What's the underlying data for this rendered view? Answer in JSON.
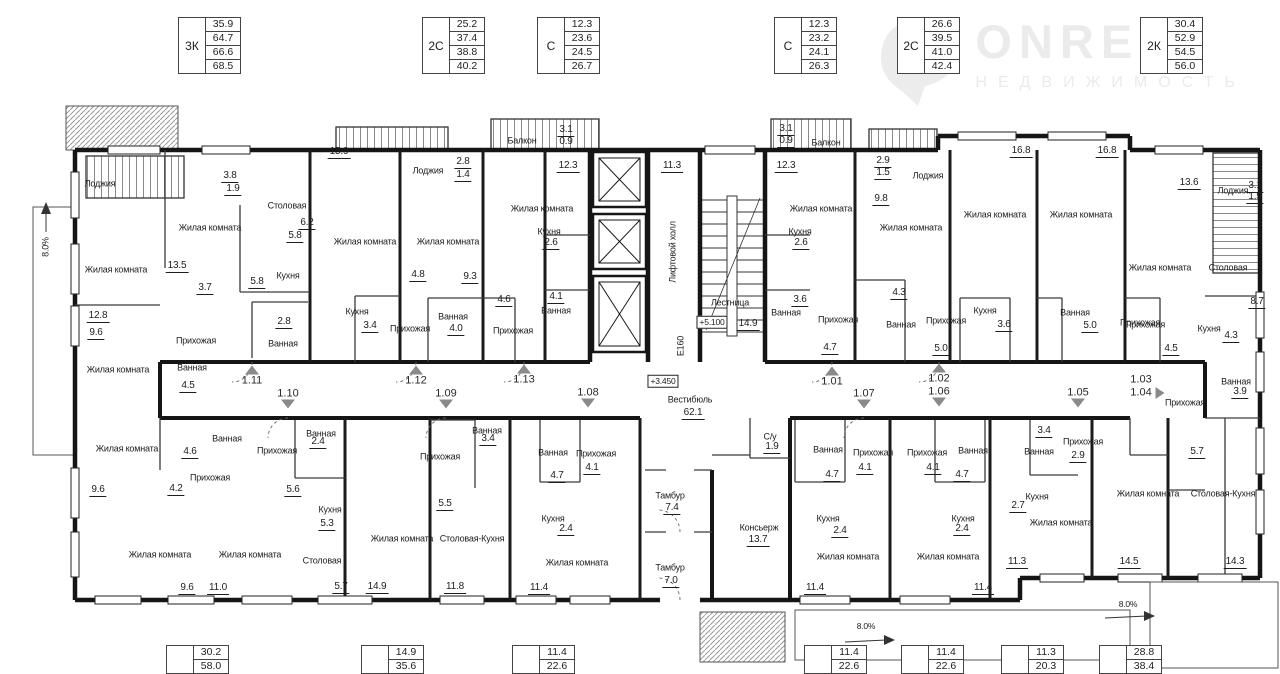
{
  "logo": {
    "name": "ONRELT",
    "subtitle": "НЕДВИЖИМОСТЬ"
  },
  "unit_tables_top": [
    {
      "type": "3К",
      "values": [
        "35.9",
        "64.7",
        "66.6",
        "68.5"
      ],
      "x": 178,
      "y": 17
    },
    {
      "type": "2С",
      "values": [
        "25.2",
        "37.4",
        "38.8",
        "40.2"
      ],
      "x": 422,
      "y": 17
    },
    {
      "type": "С",
      "values": [
        "12.3",
        "23.6",
        "24.5",
        "26.7"
      ],
      "x": 537,
      "y": 17
    },
    {
      "type": "С",
      "values": [
        "12.3",
        "23.2",
        "24.1",
        "26.3"
      ],
      "x": 774,
      "y": 17
    },
    {
      "type": "2С",
      "values": [
        "26.6",
        "39.5",
        "41.0",
        "42.4"
      ],
      "x": 897,
      "y": 17
    },
    {
      "type": "2К",
      "values": [
        "30.4",
        "52.9",
        "54.5",
        "56.0"
      ],
      "x": 1140,
      "y": 17
    }
  ],
  "unit_tables_bottom": [
    {
      "type": "",
      "values": [
        "30.2",
        "58.0"
      ],
      "x": 166,
      "y": 645
    },
    {
      "type": "",
      "values": [
        "14.9",
        "35.6"
      ],
      "x": 361,
      "y": 645
    },
    {
      "type": "",
      "values": [
        "11.4",
        "22.6"
      ],
      "x": 512,
      "y": 645
    },
    {
      "type": "",
      "values": [
        "11.4",
        "22.6"
      ],
      "x": 804,
      "y": 645
    },
    {
      "type": "",
      "values": [
        "11.4",
        "22.6"
      ],
      "x": 901,
      "y": 645
    },
    {
      "type": "",
      "values": [
        "11.3",
        "20.3"
      ],
      "x": 1001,
      "y": 645
    },
    {
      "type": "",
      "values": [
        "28.8",
        "38.4"
      ],
      "x": 1099,
      "y": 645
    }
  ],
  "plan": {
    "rooms": [
      {
        "t": "Лоджия",
        "x": 100,
        "y": 184
      },
      {
        "t": "Жилая комната",
        "x": 210,
        "y": 228
      },
      {
        "t": "Столовая",
        "x": 287,
        "y": 206
      },
      {
        "t": "Жилая комната",
        "x": 116,
        "y": 270
      },
      {
        "t": "Кухня",
        "x": 288,
        "y": 276
      },
      {
        "t": "Прихожая",
        "x": 196,
        "y": 341
      },
      {
        "t": "Ванная",
        "x": 283,
        "y": 344
      },
      {
        "t": "Ванная",
        "x": 192,
        "y": 368
      },
      {
        "t": "Жилая комната",
        "x": 118,
        "y": 370
      },
      {
        "t": "Лоджия",
        "x": 428,
        "y": 171
      },
      {
        "t": "Жилая комната",
        "x": 365,
        "y": 242
      },
      {
        "t": "Жилая комната",
        "x": 448,
        "y": 242
      },
      {
        "t": "Кухня",
        "x": 357,
        "y": 312
      },
      {
        "t": "Прихожая",
        "x": 410,
        "y": 329
      },
      {
        "t": "Ванная",
        "x": 453,
        "y": 317
      },
      {
        "t": "Прихожая",
        "x": 513,
        "y": 331
      },
      {
        "t": "Балкон",
        "x": 522,
        "y": 141
      },
      {
        "t": "Жилая комната",
        "x": 542,
        "y": 209
      },
      {
        "t": "Кухня",
        "x": 549,
        "y": 232
      },
      {
        "t": "Ванная",
        "x": 556,
        "y": 311
      },
      {
        "t": "Балкон",
        "x": 826,
        "y": 143
      },
      {
        "t": "Жилая комната",
        "x": 821,
        "y": 209
      },
      {
        "t": "Кухня",
        "x": 800,
        "y": 232
      },
      {
        "t": "Ванная",
        "x": 786,
        "y": 313
      },
      {
        "t": "Прихожая",
        "x": 838,
        "y": 320
      },
      {
        "t": "Лоджия",
        "x": 928,
        "y": 176
      },
      {
        "t": "Жилая комната",
        "x": 911,
        "y": 228
      },
      {
        "t": "Жилая комната",
        "x": 995,
        "y": 215
      },
      {
        "t": "Жилая комната",
        "x": 1081,
        "y": 215
      },
      {
        "t": "Ванная",
        "x": 901,
        "y": 325
      },
      {
        "t": "Прихожая",
        "x": 946,
        "y": 321
      },
      {
        "t": "Кухня",
        "x": 985,
        "y": 311
      },
      {
        "t": "Ванная",
        "x": 1075,
        "y": 313
      },
      {
        "t": "Прихожая",
        "x": 1140,
        "y": 323
      },
      {
        "t": "Лоджия",
        "x": 1233,
        "y": 191
      },
      {
        "t": "Жилая комната",
        "x": 1160,
        "y": 268
      },
      {
        "t": "Столовая",
        "x": 1228,
        "y": 268
      },
      {
        "t": "Прихожая",
        "x": 1145,
        "y": 325
      },
      {
        "t": "Кухня",
        "x": 1209,
        "y": 329
      },
      {
        "t": "Ванная",
        "x": 1236,
        "y": 382
      },
      {
        "t": "Лестница",
        "x": 730,
        "y": 303
      },
      {
        "t": "Вестибюль",
        "x": 690,
        "y": 400
      },
      {
        "t": "Тамбур",
        "x": 670,
        "y": 496
      },
      {
        "t": "Тамбур",
        "x": 670,
        "y": 568
      },
      {
        "t": "Консьерж",
        "x": 759,
        "y": 528
      },
      {
        "t": "С/у",
        "x": 770,
        "y": 437
      },
      {
        "t": "Ванная",
        "x": 227,
        "y": 439
      },
      {
        "t": "Жилая комната",
        "x": 127,
        "y": 449
      },
      {
        "t": "Прихожая",
        "x": 277,
        "y": 451
      },
      {
        "t": "Прихожая",
        "x": 210,
        "y": 478
      },
      {
        "t": "Ванная",
        "x": 321,
        "y": 434
      },
      {
        "t": "Кухня",
        "x": 330,
        "y": 510
      },
      {
        "t": "Жилая комната",
        "x": 160,
        "y": 555
      },
      {
        "t": "Жилая комната",
        "x": 250,
        "y": 555
      },
      {
        "t": "Столовая",
        "x": 322,
        "y": 561
      },
      {
        "t": "Жилая комната",
        "x": 402,
        "y": 539
      },
      {
        "t": "Столовая-Кухня",
        "x": 472,
        "y": 539
      },
      {
        "t": "Прихожая",
        "x": 440,
        "y": 457
      },
      {
        "t": "Ванная",
        "x": 487,
        "y": 431
      },
      {
        "t": "Ванная",
        "x": 553,
        "y": 453
      },
      {
        "t": "Прихожая",
        "x": 596,
        "y": 454
      },
      {
        "t": "Кухня",
        "x": 553,
        "y": 519
      },
      {
        "t": "Жилая комната",
        "x": 577,
        "y": 563
      },
      {
        "t": "Ванная",
        "x": 828,
        "y": 450
      },
      {
        "t": "Прихожая",
        "x": 873,
        "y": 453
      },
      {
        "t": "Кухня",
        "x": 828,
        "y": 519
      },
      {
        "t": "Жилая комната",
        "x": 848,
        "y": 557
      },
      {
        "t": "Прихожая",
        "x": 927,
        "y": 453
      },
      {
        "t": "Ванная",
        "x": 973,
        "y": 451
      },
      {
        "t": "Кухня",
        "x": 963,
        "y": 519
      },
      {
        "t": "Жилая комната",
        "x": 948,
        "y": 557
      },
      {
        "t": "Ванная",
        "x": 1039,
        "y": 452
      },
      {
        "t": "Прихожая",
        "x": 1083,
        "y": 442
      },
      {
        "t": "Кухня",
        "x": 1037,
        "y": 497
      },
      {
        "t": "Жилая комната",
        "x": 1061,
        "y": 523
      },
      {
        "t": "Прихожая",
        "x": 1185,
        "y": 403
      },
      {
        "t": "Жилая комната",
        "x": 1148,
        "y": 494
      },
      {
        "t": "Столовая-Кухня",
        "x": 1223,
        "y": 494
      }
    ],
    "areas": [
      {
        "t": "3.8",
        "x": 230,
        "y": 177
      },
      {
        "t": "1.9",
        "x": 233,
        "y": 190
      },
      {
        "t": "13.5",
        "x": 177,
        "y": 267
      },
      {
        "t": "6.2",
        "x": 307,
        "y": 224
      },
      {
        "t": "5.8",
        "x": 295,
        "y": 237
      },
      {
        "t": "5.8",
        "x": 257,
        "y": 283
      },
      {
        "t": "3.7",
        "x": 205,
        "y": 289
      },
      {
        "t": "12.8",
        "x": 98,
        "y": 317
      },
      {
        "t": "9.6",
        "x": 96,
        "y": 334
      },
      {
        "t": "2.8",
        "x": 284,
        "y": 323
      },
      {
        "t": "4.5",
        "x": 188,
        "y": 387
      },
      {
        "t": "15.9",
        "x": 339,
        "y": 153
      },
      {
        "t": "2.8",
        "x": 463,
        "y": 163
      },
      {
        "t": "1.4",
        "x": 463,
        "y": 176
      },
      {
        "t": "4.8",
        "x": 418,
        "y": 276
      },
      {
        "t": "9.3",
        "x": 470,
        "y": 278
      },
      {
        "t": "3.4",
        "x": 370,
        "y": 327
      },
      {
        "t": "4.0",
        "x": 456,
        "y": 330
      },
      {
        "t": "4.6",
        "x": 504,
        "y": 301
      },
      {
        "t": "3.1",
        "x": 566,
        "y": 131
      },
      {
        "t": "0.9",
        "x": 566,
        "y": 143
      },
      {
        "t": "12.3",
        "x": 568,
        "y": 167
      },
      {
        "t": "2.6",
        "x": 551,
        "y": 244
      },
      {
        "t": "4.1",
        "x": 556,
        "y": 298
      },
      {
        "t": "11.3",
        "x": 672,
        "y": 167
      },
      {
        "t": "14.9",
        "x": 748,
        "y": 325
      },
      {
        "t": "3.1",
        "x": 786,
        "y": 130
      },
      {
        "t": "0.9",
        "x": 786,
        "y": 142
      },
      {
        "t": "12.3",
        "x": 786,
        "y": 167
      },
      {
        "t": "2.6",
        "x": 801,
        "y": 244
      },
      {
        "t": "3.6",
        "x": 800,
        "y": 301
      },
      {
        "t": "4.7",
        "x": 830,
        "y": 349
      },
      {
        "t": "2.9",
        "x": 883,
        "y": 162
      },
      {
        "t": "1.5",
        "x": 883,
        "y": 174
      },
      {
        "t": "9.8",
        "x": 881,
        "y": 200
      },
      {
        "t": "16.8",
        "x": 1021,
        "y": 152
      },
      {
        "t": "16.8",
        "x": 1107,
        "y": 152
      },
      {
        "t": "4.3",
        "x": 899,
        "y": 294
      },
      {
        "t": "5.0",
        "x": 941,
        "y": 350
      },
      {
        "t": "3.6",
        "x": 1004,
        "y": 326
      },
      {
        "t": "5.0",
        "x": 1090,
        "y": 327
      },
      {
        "t": "13.6",
        "x": 1189,
        "y": 184
      },
      {
        "t": "3.1",
        "x": 1255,
        "y": 187
      },
      {
        "t": "1.5",
        "x": 1255,
        "y": 198
      },
      {
        "t": "8.7",
        "x": 1257,
        "y": 303
      },
      {
        "t": "4.3",
        "x": 1231,
        "y": 337
      },
      {
        "t": "4.5",
        "x": 1171,
        "y": 350
      },
      {
        "t": "3.9",
        "x": 1240,
        "y": 393
      },
      {
        "t": "62.1",
        "x": 693,
        "y": 414
      },
      {
        "t": "7.4",
        "x": 672,
        "y": 509
      },
      {
        "t": "7.0",
        "x": 671,
        "y": 582
      },
      {
        "t": "13.7",
        "x": 758,
        "y": 541
      },
      {
        "t": "1.9",
        "x": 772,
        "y": 448
      },
      {
        "t": "4.6",
        "x": 190,
        "y": 453
      },
      {
        "t": "4.2",
        "x": 176,
        "y": 490
      },
      {
        "t": "9.6",
        "x": 98,
        "y": 491
      },
      {
        "t": "2.4",
        "x": 318,
        "y": 443
      },
      {
        "t": "5.6",
        "x": 293,
        "y": 491
      },
      {
        "t": "5.3",
        "x": 327,
        "y": 525
      },
      {
        "t": "9.6",
        "x": 187,
        "y": 589
      },
      {
        "t": "11.0",
        "x": 218,
        "y": 589
      },
      {
        "t": "5.7",
        "x": 341,
        "y": 588
      },
      {
        "t": "14.9",
        "x": 377,
        "y": 588
      },
      {
        "t": "11.8",
        "x": 455,
        "y": 588
      },
      {
        "t": "3.4",
        "x": 488,
        "y": 440
      },
      {
        "t": "5.5",
        "x": 445,
        "y": 505
      },
      {
        "t": "4.7",
        "x": 557,
        "y": 477
      },
      {
        "t": "4.1",
        "x": 592,
        "y": 469
      },
      {
        "t": "2.4",
        "x": 566,
        "y": 530
      },
      {
        "t": "11.4",
        "x": 539,
        "y": 589
      },
      {
        "t": "4.7",
        "x": 832,
        "y": 476
      },
      {
        "t": "4.1",
        "x": 865,
        "y": 469
      },
      {
        "t": "2.4",
        "x": 840,
        "y": 532
      },
      {
        "t": "11.4",
        "x": 815,
        "y": 589
      },
      {
        "t": "4.1",
        "x": 933,
        "y": 469
      },
      {
        "t": "4.7",
        "x": 962,
        "y": 476
      },
      {
        "t": "2.4",
        "x": 962,
        "y": 530
      },
      {
        "t": "11.4",
        "x": 983,
        "y": 589
      },
      {
        "t": "3.4",
        "x": 1044,
        "y": 432
      },
      {
        "t": "2.9",
        "x": 1078,
        "y": 457
      },
      {
        "t": "2.7",
        "x": 1018,
        "y": 507
      },
      {
        "t": "11.3",
        "x": 1017,
        "y": 563
      },
      {
        "t": "5.7",
        "x": 1197,
        "y": 453
      },
      {
        "t": "14.5",
        "x": 1129,
        "y": 563
      },
      {
        "t": "14.3",
        "x": 1235,
        "y": 563
      }
    ],
    "levels": [
      {
        "t": "+5.100",
        "x": 712,
        "y": 322
      },
      {
        "t": "+3.450",
        "x": 663,
        "y": 381
      }
    ],
    "rotated": [
      {
        "t": "Лифтовой холл",
        "x": 673,
        "y": 252
      },
      {
        "t": "E160",
        "x": 681,
        "y": 346
      },
      {
        "t": "8.0%",
        "x": 46,
        "y": 247
      }
    ],
    "ramps": [
      {
        "t": "8.0%",
        "x": 866,
        "y": 626
      },
      {
        "t": "8.0%",
        "x": 1128,
        "y": 604
      }
    ],
    "apartments": [
      {
        "n": "1.11",
        "x": 252,
        "y": 381,
        "d": "up"
      },
      {
        "n": "1.10",
        "x": 288,
        "y": 394,
        "d": "down"
      },
      {
        "n": "1.12",
        "x": 416,
        "y": 381,
        "d": "up"
      },
      {
        "n": "1.09",
        "x": 446,
        "y": 394,
        "d": "down"
      },
      {
        "n": "1.13",
        "x": 524,
        "y": 380,
        "d": "up"
      },
      {
        "n": "1.08",
        "x": 588,
        "y": 393,
        "d": "down"
      },
      {
        "n": "1.01",
        "x": 832,
        "y": 382,
        "d": "up"
      },
      {
        "n": "1.07",
        "x": 864,
        "y": 394,
        "d": "down"
      },
      {
        "n": "1.02",
        "x": 939,
        "y": 379,
        "d": "up"
      },
      {
        "n": "1.06",
        "x": 939,
        "y": 392,
        "d": "down"
      },
      {
        "n": "1.05",
        "x": 1078,
        "y": 393,
        "d": "down"
      },
      {
        "n": "1.03",
        "x": 1141,
        "y": 380,
        "d": "none"
      },
      {
        "n": "1.04",
        "x": 1141,
        "y": 393,
        "d": "right"
      }
    ]
  }
}
